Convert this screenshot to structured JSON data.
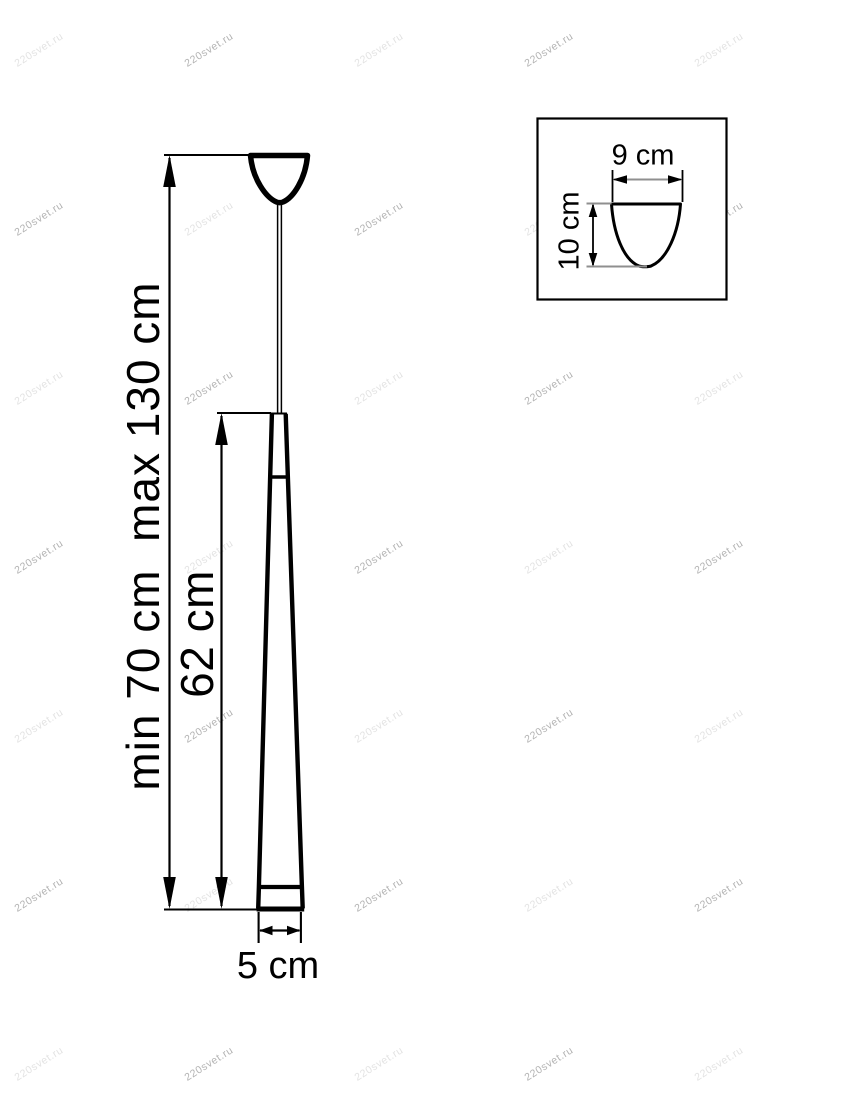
{
  "watermark": {
    "text": "220svet.ru",
    "color_strong": "#b3b3b3",
    "color_faint": "#e3e3e3",
    "angle_deg": -32,
    "grid": {
      "x_start": 39,
      "x_step": 170,
      "cols": 5,
      "y_start": 50,
      "y_step": 169,
      "rows": 7
    }
  },
  "drawing": {
    "stroke_color": "#000000",
    "extension_color": "#8f8f8f",
    "labels": {
      "suspension_height": "min 70 cm  max 130 cm",
      "shade_height": "62 cm",
      "shade_diameter": "5 cm"
    },
    "inset": {
      "canopy_diameter": "9 cm",
      "canopy_height": "10 cm"
    }
  }
}
